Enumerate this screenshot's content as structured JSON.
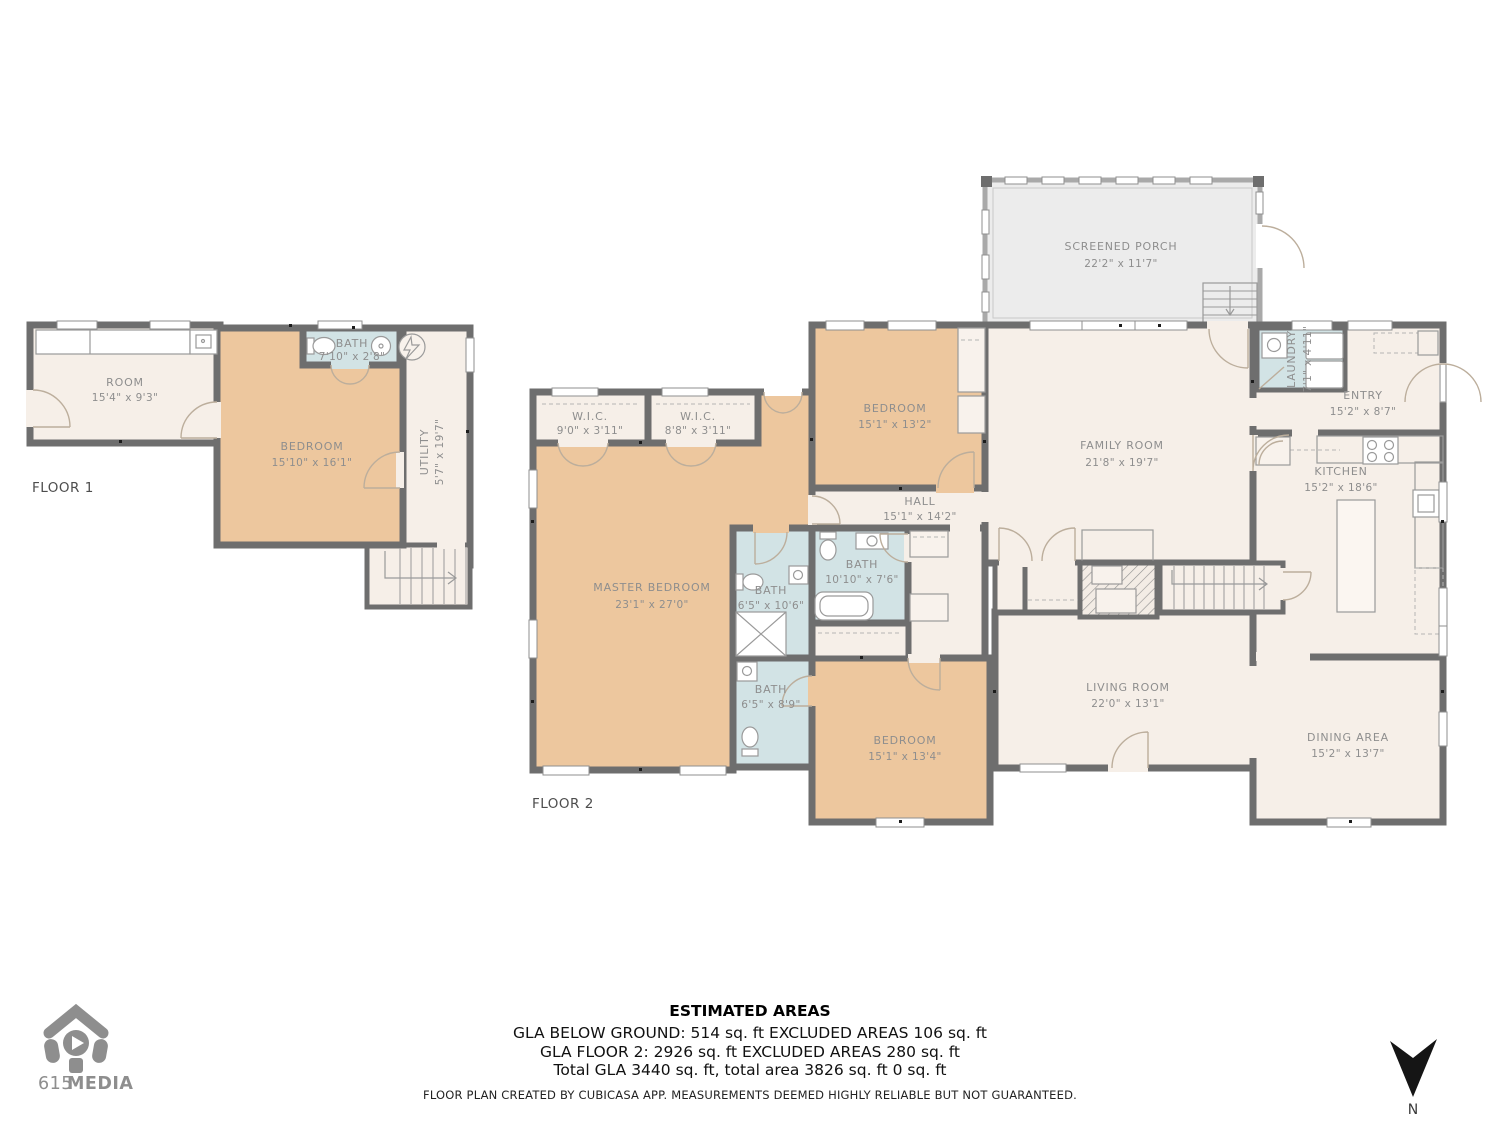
{
  "f1": {
    "label": "FLOOR 1",
    "room": {
      "n": "ROOM",
      "d": "15'4\" x 9'3\""
    },
    "bedroom": {
      "n": "BEDROOM",
      "d": "15'10\" x 16'1\""
    },
    "bath": {
      "n": "BATH",
      "d": "7'10\" x 2'8\""
    },
    "utility": {
      "n": "UTILITY",
      "d": "5'7\" x 19'7\""
    }
  },
  "f2": {
    "label": "FLOOR 2",
    "porch": {
      "n": "SCREENED PORCH",
      "d": "22'2\" x 11'7\""
    },
    "bedroom_top": {
      "n": "BEDROOM",
      "d": "15'1\" x 13'2\""
    },
    "family": {
      "n": "FAMILY ROOM",
      "d": "21'8\" x 19'7\""
    },
    "laundry": {
      "n": "LAUNDRY",
      "d": "7'1\" x 4'11\""
    },
    "entry": {
      "n": "ENTRY",
      "d": "15'2\" x 8'7\""
    },
    "kitchen": {
      "n": "KITCHEN",
      "d": "15'2\" x 18'6\""
    },
    "wic1": {
      "n": "W.I.C.",
      "d": "9'0\" x 3'11\""
    },
    "wic2": {
      "n": "W.I.C.",
      "d": "8'8\" x 3'11\""
    },
    "hall": {
      "n": "HALL",
      "d": "15'1\" x 14'2\""
    },
    "master": {
      "n": "MASTER BEDROOM",
      "d": "23'1\" x 27'0\""
    },
    "bath_ensuite": {
      "n": "BATH",
      "d": "6'5\" x 10'6\""
    },
    "bath_main": {
      "n": "BATH",
      "d": "10'10\" x 7'6\""
    },
    "bath_small": {
      "n": "BATH",
      "d": "6'5\" x 8'9\""
    },
    "bedroom_bottom": {
      "n": "BEDROOM",
      "d": "15'1\" x 13'4\""
    },
    "living": {
      "n": "LIVING ROOM",
      "d": "22'0\" x 13'1\""
    },
    "dining": {
      "n": "DINING AREA",
      "d": "15'2\" x 13'7\""
    }
  },
  "footer": {
    "title": "ESTIMATED AREAS",
    "line1": "GLA BELOW GROUND: 514 sq. ft EXCLUDED AREAS 106 sq. ft",
    "line2": "GLA FLOOR 2: 2926 sq. ft EXCLUDED AREAS 280 sq. ft",
    "line3": "Total GLA 3440 sq. ft, total area 3826 sq. ft 0 sq. ft",
    "disclaimer": "FLOOR PLAN CREATED BY CUBICASA APP. MEASUREMENTS DEEMED HIGHLY RELIABLE BUT NOT GUARANTEED."
  },
  "logo": {
    "prefix": "615",
    "suffix": "MEDIA"
  },
  "compass": {
    "label": "N"
  },
  "colors": {
    "wall": "#6e6e6e",
    "room": "#f6efe8",
    "bedroom": "#edc79e",
    "bath": "#d2e3e5",
    "porch": "#ececec"
  }
}
